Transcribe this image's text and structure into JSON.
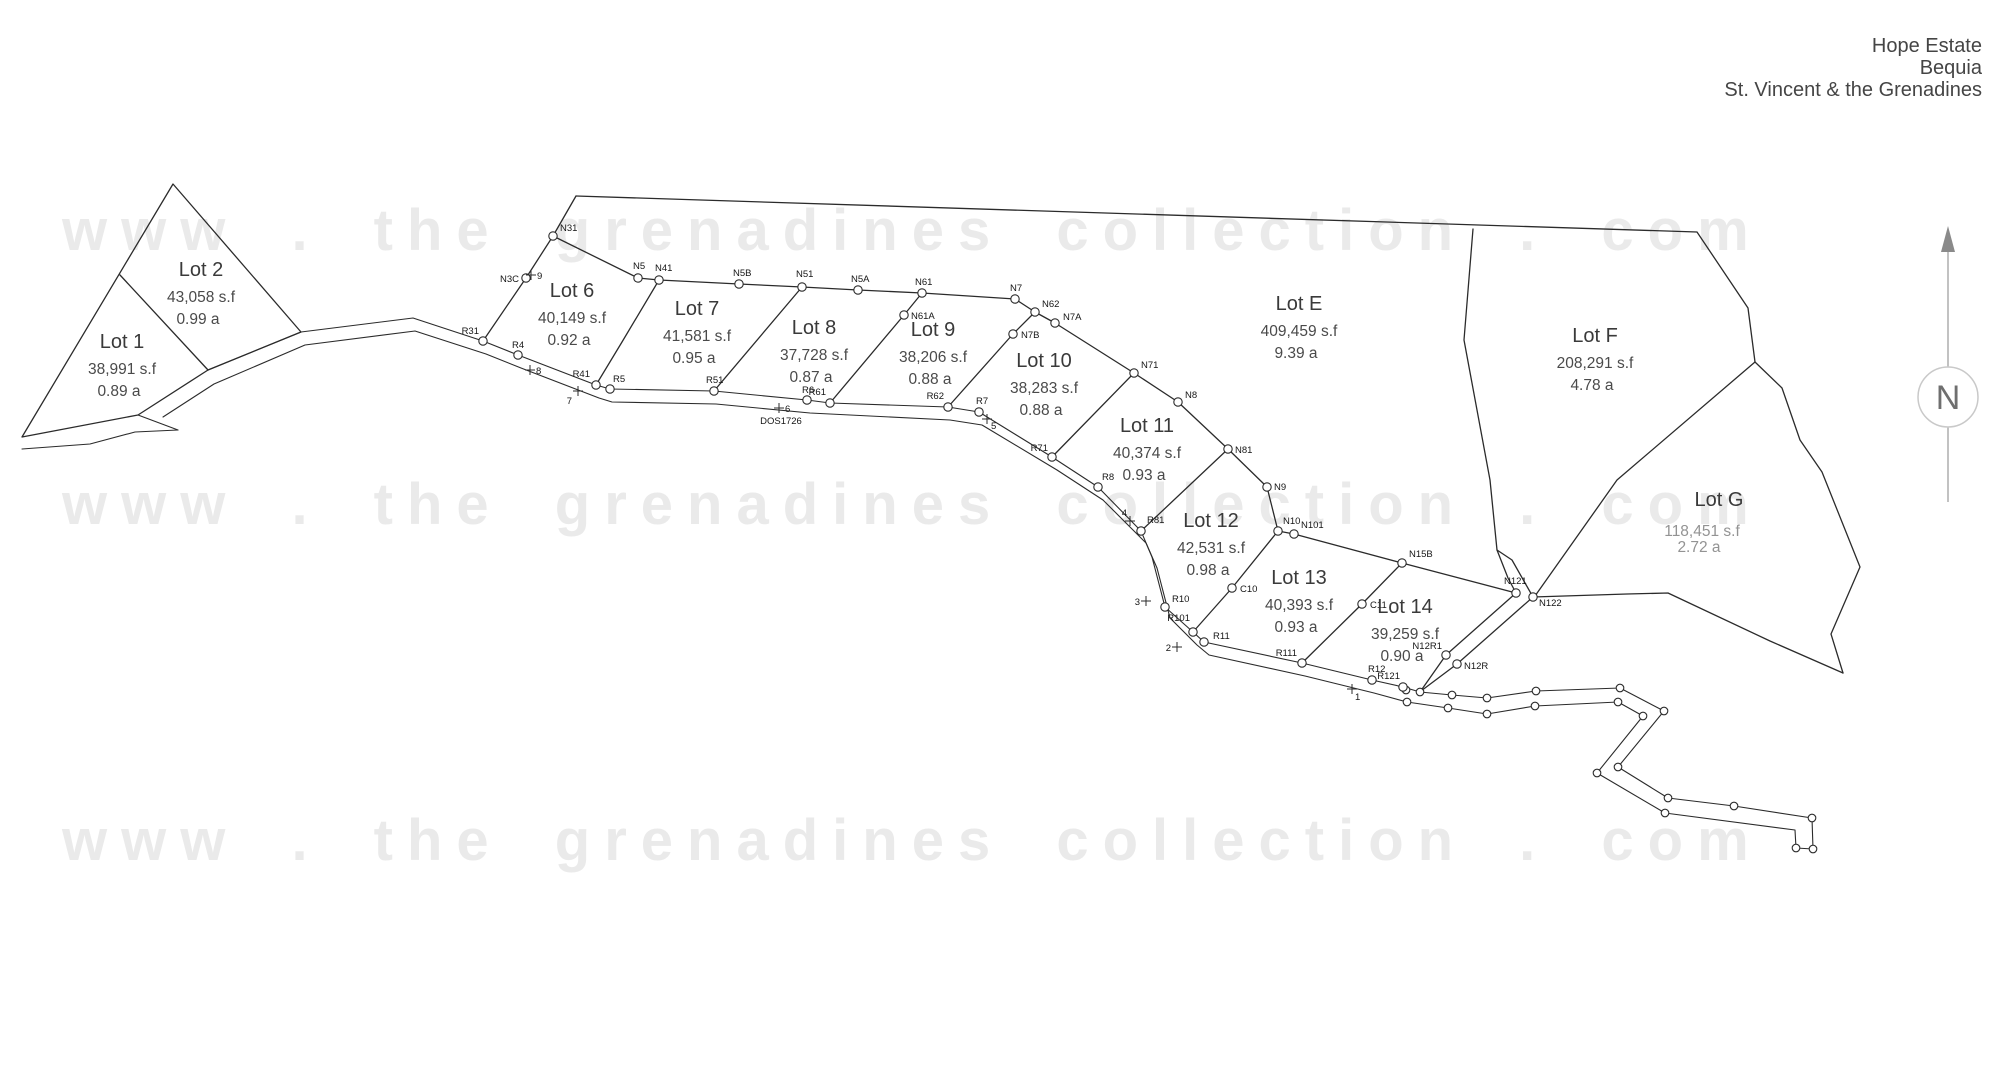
{
  "title": {
    "lines": [
      "Hope Estate",
      "Bequia",
      "St. Vincent & the Grenadines"
    ]
  },
  "watermark": {
    "text": "www . the grenadines collection . com",
    "color": "#eaeaea"
  },
  "compass": {
    "label": "N"
  },
  "road_label": "DOS1726",
  "colors": {
    "line": "#2b2b2b",
    "lot_text": "#3a3a3a",
    "muted_text": "#939393",
    "watermark": "#eaeaea",
    "background": "#ffffff"
  },
  "lots": [
    {
      "id": "1",
      "name": "Lot 1",
      "sf": "38,991 s.f",
      "ac": "0.89 a",
      "x": 122,
      "y": 348
    },
    {
      "id": "2",
      "name": "Lot 2",
      "sf": "43,058 s.f",
      "ac": "0.99 a",
      "x": 201,
      "y": 276
    },
    {
      "id": "6",
      "name": "Lot 6",
      "sf": "40,149 s.f",
      "ac": "0.92 a",
      "x": 572,
      "y": 297
    },
    {
      "id": "7",
      "name": "Lot 7",
      "sf": "41,581 s.f",
      "ac": "0.95 a",
      "x": 697,
      "y": 315
    },
    {
      "id": "8",
      "name": "Lot 8",
      "sf": "37,728 s.f",
      "ac": "0.87 a",
      "x": 814,
      "y": 334
    },
    {
      "id": "9",
      "name": "Lot 9",
      "sf": "38,206 s.f",
      "ac": "0.88 a",
      "x": 933,
      "y": 336
    },
    {
      "id": "10",
      "name": "Lot 10",
      "sf": "38,283 s.f",
      "ac": "0.88 a",
      "x": 1044,
      "y": 367
    },
    {
      "id": "11",
      "name": "Lot 11",
      "sf": "40,374 s.f",
      "ac": "0.93 a",
      "x": 1147,
      "y": 432
    },
    {
      "id": "12",
      "name": "Lot 12",
      "sf": "42,531 s.f",
      "ac": "0.98 a",
      "x": 1211,
      "y": 527
    },
    {
      "id": "13",
      "name": "Lot 13",
      "sf": "40,393 s.f",
      "ac": "0.93 a",
      "x": 1299,
      "y": 584
    },
    {
      "id": "14",
      "name": "Lot 14",
      "sf": "39,259 s.f",
      "ac": "0.90 a",
      "x": 1405,
      "y": 613
    },
    {
      "id": "E",
      "name": "Lot E",
      "sf": "409,459 s.f",
      "ac": "9.39 a",
      "x": 1299,
      "y": 310
    },
    {
      "id": "F",
      "name": "Lot F",
      "sf": "208,291 s.f",
      "ac": "4.78 a",
      "x": 1595,
      "y": 342
    },
    {
      "id": "G",
      "name": "Lot G",
      "sf": "118,451 s.f",
      "ac": "2.72 a",
      "x": 1719,
      "y": 506,
      "sf_x": 1702,
      "sf_dy": 30,
      "ac_dy": 46,
      "muted": true
    }
  ],
  "survey_points": [
    {
      "label": "N31",
      "x": 553,
      "y": 236,
      "lx": 560,
      "ly": 231
    },
    {
      "label": "N3C",
      "x": 526,
      "y": 278,
      "lx": 519,
      "ly": 282,
      "anchor": "end"
    },
    {
      "label": "N5",
      "x": 638,
      "y": 278,
      "lx": 633,
      "ly": 269
    },
    {
      "label": "N41",
      "x": 659,
      "y": 280,
      "lx": 655,
      "ly": 271
    },
    {
      "label": "N5B",
      "x": 739,
      "y": 284,
      "lx": 733,
      "ly": 276
    },
    {
      "label": "N51",
      "x": 802,
      "y": 287,
      "lx": 796,
      "ly": 277
    },
    {
      "label": "N5A",
      "x": 858,
      "y": 290,
      "lx": 851,
      "ly": 282
    },
    {
      "label": "N61",
      "x": 922,
      "y": 293,
      "lx": 915,
      "ly": 285
    },
    {
      "label": "N61A",
      "x": 904,
      "y": 315,
      "lx": 911,
      "ly": 319
    },
    {
      "label": "N7",
      "x": 1015,
      "y": 299,
      "lx": 1010,
      "ly": 291
    },
    {
      "label": "N62",
      "x": 1035,
      "y": 312,
      "lx": 1042,
      "ly": 307
    },
    {
      "label": "N7A",
      "x": 1055,
      "y": 323,
      "lx": 1063,
      "ly": 320
    },
    {
      "label": "N7B",
      "x": 1013,
      "y": 334,
      "lx": 1021,
      "ly": 338
    },
    {
      "label": "N71",
      "x": 1134,
      "y": 373,
      "lx": 1141,
      "ly": 368
    },
    {
      "label": "N8",
      "x": 1178,
      "y": 402,
      "lx": 1185,
      "ly": 398
    },
    {
      "label": "N81",
      "x": 1228,
      "y": 449,
      "lx": 1235,
      "ly": 453
    },
    {
      "label": "N9",
      "x": 1267,
      "y": 487,
      "lx": 1274,
      "ly": 490
    },
    {
      "label": "N10",
      "x": 1278,
      "y": 531,
      "lx": 1283,
      "ly": 524
    },
    {
      "label": "N101",
      "x": 1294,
      "y": 534,
      "lx": 1301,
      "ly": 528
    },
    {
      "label": "N15B",
      "x": 1402,
      "y": 563,
      "lx": 1409,
      "ly": 557
    },
    {
      "label": "N121",
      "x": 1516,
      "y": 593,
      "lx": 1504,
      "ly": 584
    },
    {
      "label": "N122",
      "x": 1533,
      "y": 597,
      "lx": 1539,
      "ly": 606
    },
    {
      "label": "N12R1",
      "x": 1446,
      "y": 655,
      "lx": 1442,
      "ly": 649,
      "anchor": "end"
    },
    {
      "label": "N12R",
      "x": 1457,
      "y": 664,
      "lx": 1464,
      "ly": 669
    },
    {
      "label": "C10",
      "x": 1232,
      "y": 588,
      "lx": 1240,
      "ly": 592
    },
    {
      "label": "C11",
      "x": 1362,
      "y": 604,
      "lx": 1370,
      "ly": 608
    },
    {
      "label": "R31",
      "x": 483,
      "y": 341,
      "lx": 479,
      "ly": 334,
      "anchor": "end"
    },
    {
      "label": "R4",
      "x": 518,
      "y": 355,
      "lx": 512,
      "ly": 348
    },
    {
      "label": "R41",
      "x": 596,
      "y": 385,
      "lx": 590,
      "ly": 377,
      "anchor": "end"
    },
    {
      "label": "R5",
      "x": 610,
      "y": 389,
      "lx": 613,
      "ly": 382
    },
    {
      "label": "R51",
      "x": 714,
      "y": 391,
      "lx": 706,
      "ly": 383
    },
    {
      "label": "R6",
      "x": 807,
      "y": 400,
      "lx": 802,
      "ly": 393
    },
    {
      "label": "R61",
      "x": 830,
      "y": 403,
      "lx": 826,
      "ly": 395,
      "anchor": "end"
    },
    {
      "label": "R62",
      "x": 948,
      "y": 407,
      "lx": 944,
      "ly": 399,
      "anchor": "end"
    },
    {
      "label": "R7",
      "x": 979,
      "y": 412,
      "lx": 976,
      "ly": 404
    },
    {
      "label": "R71",
      "x": 1052,
      "y": 457,
      "lx": 1048,
      "ly": 451,
      "anchor": "end"
    },
    {
      "label": "R8",
      "x": 1098,
      "y": 487,
      "lx": 1102,
      "ly": 480
    },
    {
      "label": "R81",
      "x": 1141,
      "y": 531,
      "lx": 1147,
      "ly": 523
    },
    {
      "label": "R10",
      "x": 1165,
      "y": 607,
      "lx": 1172,
      "ly": 602
    },
    {
      "label": "R101",
      "x": 1193,
      "y": 632,
      "lx": 1190,
      "ly": 621,
      "anchor": "end"
    },
    {
      "label": "R11",
      "x": 1204,
      "y": 642,
      "lx": 1213,
      "ly": 639
    },
    {
      "label": "R111",
      "x": 1302,
      "y": 663,
      "lx": 1297,
      "ly": 656,
      "anchor": "end"
    },
    {
      "label": "R12",
      "x": 1372,
      "y": 680,
      "lx": 1368,
      "ly": 672
    },
    {
      "label": "R121",
      "x": 1403,
      "y": 687,
      "lx": 1400,
      "ly": 679,
      "anchor": "end"
    }
  ],
  "stations": [
    {
      "label": "9",
      "x": 531,
      "y": 275,
      "lx": 537,
      "ly": 279
    },
    {
      "label": "8",
      "x": 530,
      "y": 370,
      "lx": 536,
      "ly": 374
    },
    {
      "label": "7",
      "x": 578,
      "y": 391,
      "lx": 572,
      "ly": 404,
      "anchor": "end"
    },
    {
      "label": "6",
      "x": 779,
      "y": 408,
      "lx": 785,
      "ly": 412
    },
    {
      "label": "5",
      "x": 987,
      "y": 419,
      "lx": 991,
      "ly": 429
    },
    {
      "label": "4",
      "x": 1130,
      "y": 521,
      "lx": 1127,
      "ly": 516,
      "anchor": "end"
    },
    {
      "label": "3",
      "x": 1146,
      "y": 601,
      "lx": 1140,
      "ly": 605,
      "anchor": "end"
    },
    {
      "label": "2",
      "x": 1177,
      "y": 647,
      "lx": 1171,
      "ly": 651,
      "anchor": "end"
    },
    {
      "label": "1",
      "x": 1352,
      "y": 689,
      "lx": 1355,
      "ly": 700
    }
  ],
  "road_markers": [
    [
      1406,
      690
    ],
    [
      1420,
      692
    ],
    [
      1452,
      695
    ],
    [
      1487,
      698
    ],
    [
      1536,
      691
    ],
    [
      1620,
      688
    ],
    [
      1664,
      711
    ],
    [
      1618,
      767
    ],
    [
      1597,
      773
    ],
    [
      1668,
      798
    ],
    [
      1734,
      806
    ],
    [
      1812,
      818
    ],
    [
      1813,
      849
    ],
    [
      1796,
      848
    ],
    [
      1665,
      813
    ],
    [
      1643,
      716
    ],
    [
      1618,
      702
    ],
    [
      1535,
      706
    ],
    [
      1487,
      714
    ],
    [
      1448,
      708
    ],
    [
      1407,
      702
    ]
  ]
}
